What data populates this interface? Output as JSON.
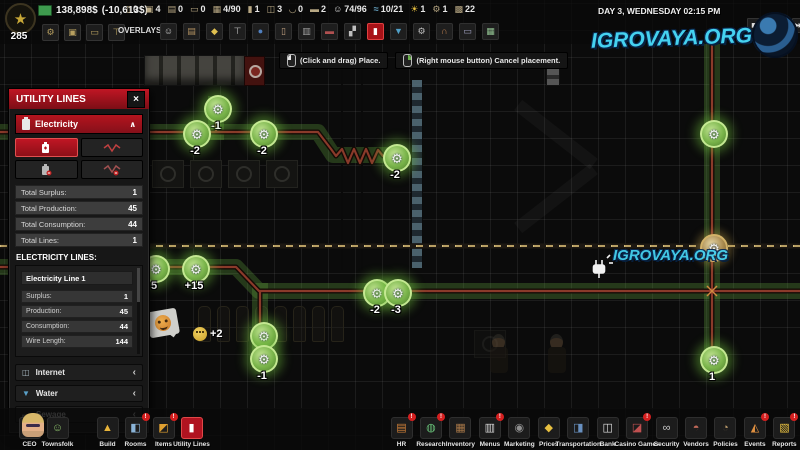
{
  "watermark": {
    "text": "IGROVAYA.ORG"
  },
  "top_bar": {
    "level": "285",
    "money": "138,898$",
    "money_delta": "(-10,613$)",
    "resources": [
      {
        "icon": "case",
        "value": "0",
        "name": "stat-cases"
      },
      {
        "icon": "photo",
        "value": "4",
        "name": "stat-pictures"
      },
      {
        "icon": "printer",
        "value": "0",
        "name": "stat-printers"
      },
      {
        "icon": "bed",
        "value": "0",
        "name": "stat-beds"
      },
      {
        "icon": "slots",
        "value": "4/90",
        "name": "stat-slots"
      },
      {
        "icon": "bottle",
        "value": "1",
        "name": "stat-bottles"
      },
      {
        "icon": "fridge",
        "value": "3",
        "name": "stat-fridges"
      },
      {
        "icon": "sink",
        "value": "0",
        "name": "stat-sinks"
      },
      {
        "icon": "desk2",
        "value": "2",
        "name": "stat-desks"
      },
      {
        "icon": "staff",
        "value": "74/96",
        "name": "stat-staff"
      },
      {
        "icon": "water2",
        "value": "10/21",
        "name": "stat-water"
      },
      {
        "icon": "sun",
        "value": "1",
        "name": "stat-day"
      },
      {
        "icon": "gear",
        "value": "1",
        "name": "stat-gears"
      },
      {
        "icon": "crate",
        "value": "22",
        "name": "stat-crates"
      }
    ],
    "quick_slots": [
      {
        "icon": "gear",
        "name": "quick-slot-gear"
      },
      {
        "icon": "flag",
        "name": "quick-slot-flag"
      },
      {
        "icon": "sofa",
        "name": "quick-slot-furniture"
      },
      {
        "icon": "hammer",
        "name": "quick-slot-build"
      }
    ],
    "overlays_label": "OVERLAYS:",
    "overlays": [
      {
        "icon": "person",
        "name": "overlay-people"
      },
      {
        "icon": "tavern",
        "name": "overlay-building"
      },
      {
        "icon": "lamp",
        "name": "overlay-light"
      },
      {
        "icon": "tools",
        "name": "overlay-construction"
      },
      {
        "icon": "camera",
        "name": "overlay-camera"
      },
      {
        "icon": "door",
        "name": "overlay-doors"
      },
      {
        "icon": "wall",
        "name": "overlay-walls"
      },
      {
        "icon": "deskov",
        "name": "overlay-furniture"
      },
      {
        "icon": "knife",
        "name": "overlay-tools"
      },
      {
        "icon": "electricity",
        "active": true,
        "name": "overlay-electricity"
      },
      {
        "icon": "waterov",
        "name": "overlay-water"
      },
      {
        "icon": "gear2",
        "name": "overlay-machines"
      },
      {
        "icon": "heat",
        "name": "overlay-heat"
      },
      {
        "icon": "furniture",
        "name": "overlay-items"
      },
      {
        "icon": "grid",
        "name": "overlay-grid"
      }
    ],
    "datetime": "DAY 3, WEDNESDAY 02:15 PM",
    "speed_controls": [
      {
        "kind": "pause",
        "name": "pause-button"
      },
      {
        "kind": "play",
        "active": true,
        "name": "play-button"
      },
      {
        "kind": "ff",
        "name": "speed2-button"
      },
      {
        "kind": "fff",
        "name": "speed3-button"
      },
      {
        "kind": "skip",
        "name": "skip-button"
      }
    ]
  },
  "hints": [
    {
      "kind": "mouse-left",
      "text": "(Click and drag) Place.",
      "name": "hint-place"
    },
    {
      "kind": "mouse-right",
      "text": "(Right mouse button) Cancel placement.",
      "name": "hint-cancel"
    }
  ],
  "panel": {
    "title": "UTILITY LINES",
    "close_label": "×",
    "electricity": {
      "label": "Electricity",
      "chevron": "∧",
      "stats": [
        {
          "label": "Total Surplus:",
          "value": "1"
        },
        {
          "label": "Total Production:",
          "value": "45"
        },
        {
          "label": "Total Consumption:",
          "value": "44"
        },
        {
          "label": "Total Lines:",
          "value": "1"
        }
      ],
      "lines_header": "ELECTRICITY LINES:",
      "line": {
        "name": "Electricity Line 1",
        "stats": [
          {
            "label": "Surplus:",
            "value": "1"
          },
          {
            "label": "Production:",
            "value": "45"
          },
          {
            "label": "Consumption:",
            "value": "44"
          },
          {
            "label": "Wire Length:",
            "value": "144"
          }
        ]
      }
    },
    "collapsed_sections": [
      {
        "icon": "net",
        "label": "Internet",
        "name": "section-internet"
      },
      {
        "icon": "waterdrop",
        "label": "Water",
        "name": "section-water"
      },
      {
        "icon": "sewage",
        "label": "Sewage",
        "name": "section-sewage"
      }
    ]
  },
  "map": {
    "emote_value": "+2",
    "nodes": [
      {
        "x": 216,
        "y": 107,
        "label": "-1",
        "name": "power-node"
      },
      {
        "x": 195,
        "y": 132,
        "label": "-2",
        "name": "power-node"
      },
      {
        "x": 262,
        "y": 132,
        "label": "-2",
        "name": "power-node"
      },
      {
        "x": 395,
        "y": 156,
        "label": "-2",
        "name": "power-node"
      },
      {
        "x": 154,
        "y": 267,
        "label": "5",
        "name": "power-node"
      },
      {
        "x": 194,
        "y": 267,
        "label": "+15",
        "name": "power-node-generator"
      },
      {
        "x": 262,
        "y": 334,
        "label": "",
        "name": "power-node"
      },
      {
        "x": 262,
        "y": 357,
        "label": "-1",
        "name": "power-node"
      },
      {
        "x": 375,
        "y": 291,
        "label": "-2",
        "name": "power-node"
      },
      {
        "x": 396,
        "y": 291,
        "label": "-3",
        "name": "power-node"
      },
      {
        "x": 712,
        "y": 132,
        "label": "",
        "name": "power-node"
      },
      {
        "x": 712,
        "y": 246,
        "label": "",
        "tan": true,
        "name": "utility-node"
      },
      {
        "x": 712,
        "y": 358,
        "label": "1",
        "name": "power-node"
      }
    ]
  },
  "bottom_bar": {
    "left": [
      {
        "icon": "ceo",
        "label": "CEO",
        "name": "tb-ceo"
      },
      {
        "icon": "townsfolk",
        "label": "Townsfolk",
        "name": "tb-townsfolk"
      },
      {
        "icon": "build",
        "label": "Build",
        "gapL": true,
        "name": "tb-build"
      },
      {
        "icon": "rooms",
        "label": "Rooms",
        "badge": true,
        "name": "tb-rooms"
      },
      {
        "icon": "items",
        "label": "Items",
        "badge": true,
        "name": "tb-items"
      },
      {
        "icon": "utility",
        "label": "Utility Lines",
        "active": true,
        "name": "tb-utility-lines"
      }
    ],
    "right": [
      {
        "icon": "hr",
        "label": "HR",
        "badge": true,
        "name": "tb-hr"
      },
      {
        "icon": "research",
        "label": "Research",
        "badge": true,
        "name": "tb-research"
      },
      {
        "icon": "inventory",
        "label": "Inventory",
        "name": "tb-inventory"
      },
      {
        "icon": "menus",
        "label": "Menus",
        "badge": true,
        "name": "tb-menus"
      },
      {
        "icon": "marketing",
        "label": "Marketing",
        "name": "tb-marketing"
      },
      {
        "icon": "prices",
        "label": "Prices",
        "name": "tb-prices"
      },
      {
        "icon": "transportation",
        "label": "Transportation",
        "name": "tb-transportation"
      },
      {
        "icon": "bank",
        "label": "Bank",
        "name": "tb-bank"
      },
      {
        "icon": "casino",
        "label": "Casino Games",
        "badge": true,
        "name": "tb-casino-games"
      },
      {
        "icon": "security",
        "label": "Security",
        "name": "tb-security"
      },
      {
        "icon": "vendors",
        "label": "Vendors",
        "name": "tb-vendors"
      },
      {
        "icon": "policies",
        "label": "Policies",
        "name": "tb-policies"
      },
      {
        "icon": "events",
        "label": "Events",
        "badge": true,
        "name": "tb-events"
      },
      {
        "icon": "reports",
        "label": "Reports",
        "badge": true,
        "name": "tb-reports"
      }
    ]
  }
}
